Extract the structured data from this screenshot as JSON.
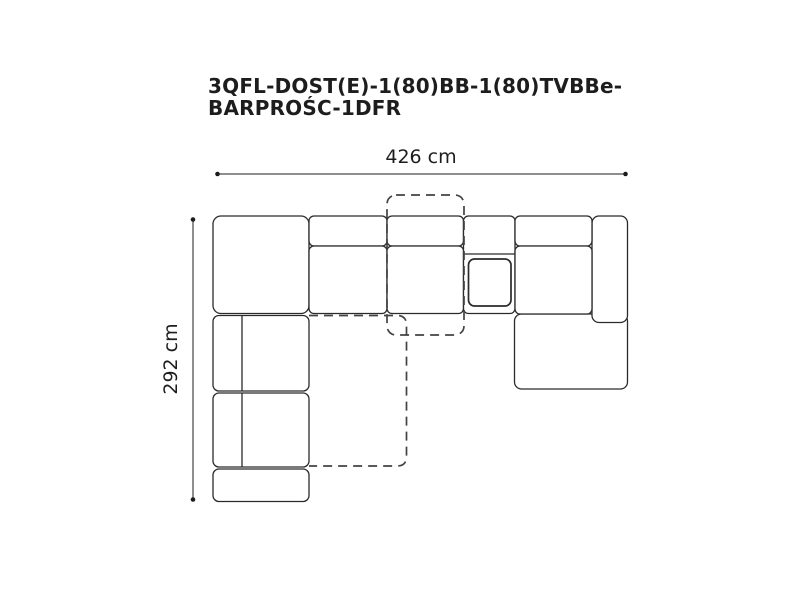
{
  "page": {
    "background": "#ffffff"
  },
  "product": {
    "title_line1": "3QFL-DOST(E)-1(80)BB-1(80)TVBBe-",
    "title_line2": "BARPROŚC-1DFR"
  },
  "dimensions": {
    "width_label": "426 cm",
    "width_cm": 426,
    "depth_label": "292 cm",
    "depth_cm": 292
  },
  "colors": {
    "outline": "#2b2b2b",
    "dashed_outline": "#434343",
    "dimension_line": "#1c1c1c",
    "text": "#1d1d1d"
  }
}
